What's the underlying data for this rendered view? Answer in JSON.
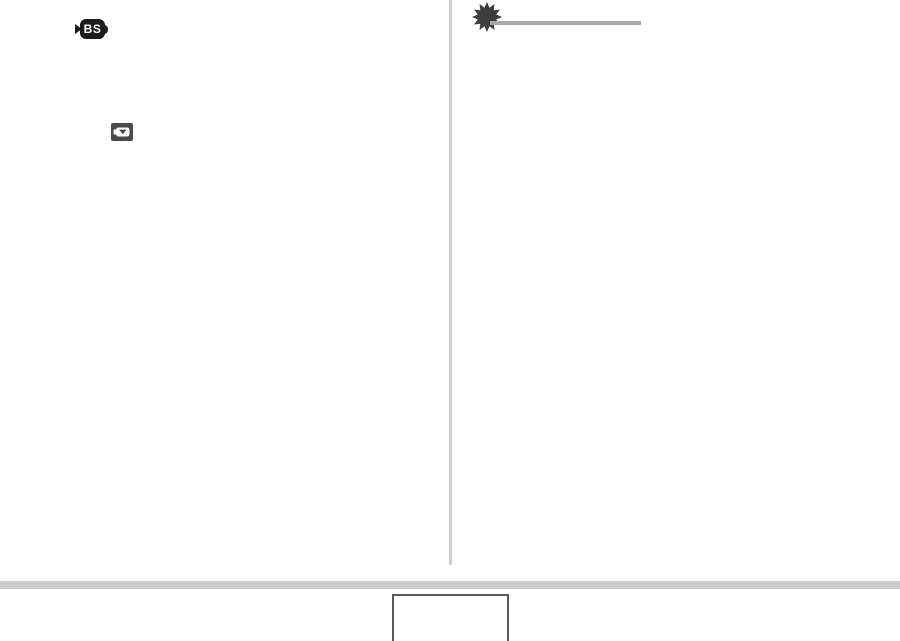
{
  "page": {
    "kind": "camera-manual-page",
    "background": "#ffffff"
  },
  "left_column": {
    "bestshot_icon": {
      "label": "BS",
      "badge_color": "#1c1c1c",
      "text_color": "#ffffff"
    },
    "camera_icon": {
      "badge_color": "#4a4a4a",
      "glyph_color": "#ffffff"
    }
  },
  "right_column": {
    "starburst_icon": {
      "color": "#3d3d3d",
      "points": 12
    },
    "heading_rule_color": "#a9a9a9"
  },
  "column_divider_color": "#cdcdcd",
  "footer": {
    "bar_color": "#cdcdcd",
    "page_number_box": {
      "border_color": "#5a5a5a",
      "fill": "#ffffff"
    }
  }
}
